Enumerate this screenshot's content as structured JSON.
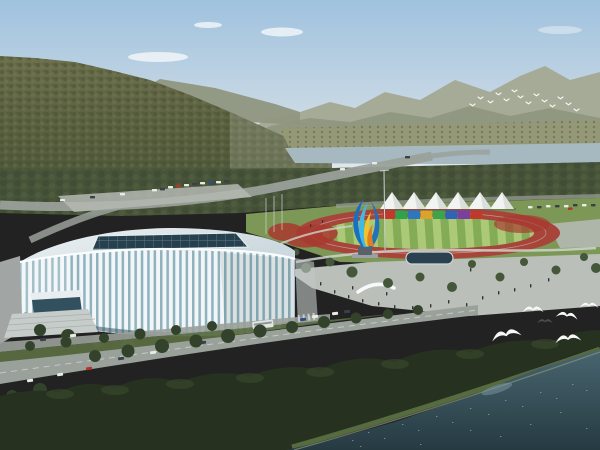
{
  "description": "Aerial architectural rendering of a riverside sports park: white lattice-facade stadium, athletics track with white event tents and a rainbow banner wall, colorful ribbon sculpture, tree-lined boulevards, forested hills, a river, and gulls over dark water.",
  "scene": {
    "sky": {
      "top": "#9fc2de",
      "mid": "#c6d7e4",
      "horizon": "#e2e8ea",
      "cloud": "#f5f8fa"
    },
    "mountains": {
      "far": "#a6ab97",
      "near": "#8f967e",
      "haze": "#c9cec0"
    },
    "hill": {
      "top": "#6c6f4c",
      "bottom": "#505a3b",
      "texture_dark": "#454d30",
      "texture_light": "#7a7c55"
    },
    "river": {
      "water": "#a7b9c0",
      "bank": "#949876",
      "bank_dots": "#6e7355"
    },
    "treeband": {
      "fill": "#47543a",
      "texture_dark": "#39462e",
      "texture_light": "#5e6d45"
    },
    "roads": {
      "asphalt": "#9aa09a",
      "light": "#b4b9b2",
      "verge": "#5d7044",
      "marking": "#d8dcd6"
    },
    "park": {
      "lawn": "#7d9756",
      "track": "#a8453a",
      "infield_light": "#abc976",
      "infield_dark": "#84ab56",
      "lane_line": "#e3e6e2",
      "flowers": "#a83a2f",
      "plaza": "#babfb9",
      "path": "#ced3cd",
      "pool": "#2a4150",
      "pool_rim": "#cfd5d3",
      "tent": "#f2f4f1",
      "tent_shade": "#d7dcd8",
      "banner_colors": [
        "#bf3a2b",
        "#2fa24d",
        "#2e77bd",
        "#d9a42c",
        "#3aa54a",
        "#2e63b5",
        "#7d3f9e",
        "#bf3a2b"
      ],
      "tree": "#44573a",
      "tree_dark": "#33432b"
    },
    "sculpture": {
      "blue": "#1c6fbe",
      "cyan": "#41b9e6",
      "yellow": "#f3c32f",
      "orange": "#e0801e",
      "pedestal": "#5a6168",
      "base": "#9aa0a4"
    },
    "stadium": {
      "roof": "#eef3f5",
      "roof_shade": "#ccd9de",
      "fascia": "#fafdfe",
      "rib": "#f2f6f8",
      "glass": "#8fb2bd",
      "glass_dark": "#44606c",
      "skylight": "#26404e",
      "skylight_grid": "#5e7a88",
      "apron": "#c2c8c6",
      "stairs": "#c6ccca",
      "stair_line": "#a9b0ae",
      "entrance": "#33505e"
    },
    "foreground": {
      "forest": "#26321f",
      "canopy_light": "#3e4f30",
      "shore": "#5c7244",
      "sand": "#8c937b"
    },
    "water": {
      "top": "#48656f",
      "bottom": "#263a42",
      "sparkle": "#8fa9b2",
      "glint": "#7e99a2"
    },
    "vehicles": {
      "white": "#e9ebe7",
      "dark": "#394048",
      "red": "#b23527",
      "blue": "#2d4f8a",
      "bus": "#e2e6e2",
      "bus_stripe": "#8e959b"
    },
    "birds": {
      "white": "#f7f9f7",
      "dark": "#46524a"
    },
    "people": {
      "fill": "#2e3438"
    },
    "counts": {
      "tents": 6,
      "banner_panels": 8,
      "foreground_gulls": 6,
      "distant_flock": 14
    }
  }
}
